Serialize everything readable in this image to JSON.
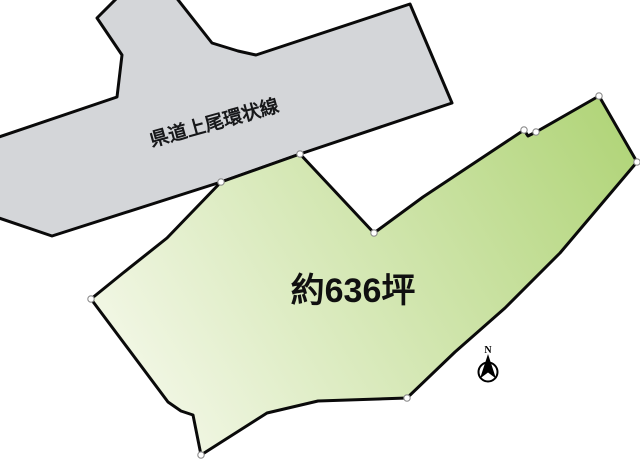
{
  "canvas": {
    "width": 640,
    "height": 461,
    "background": "#ffffff"
  },
  "road": {
    "label": "県道上尾環状線",
    "fill": "#d4d6d9",
    "stroke": "#0a0a0a",
    "stroke_width": 3,
    "points": [
      [
        119,
        -4
      ],
      [
        175,
        -4
      ],
      [
        212,
        43
      ],
      [
        238,
        51
      ],
      [
        256,
        55
      ],
      [
        410,
        4
      ],
      [
        452,
        103
      ],
      [
        300,
        154
      ],
      [
        221,
        182
      ],
      [
        52,
        236
      ],
      [
        -4,
        217
      ],
      [
        -4,
        138
      ],
      [
        117,
        97
      ],
      [
        122,
        55
      ],
      [
        97,
        18
      ]
    ],
    "label_center": [
      216,
      129
    ],
    "label_rotation_deg": -15.5,
    "label_font_size": 19
  },
  "parcel": {
    "label": "約636坪",
    "fill_gradient": {
      "from": "#f6f9ec",
      "to": "#aed374",
      "x1": 120,
      "y1": 430,
      "x2": 645,
      "y2": 110
    },
    "stroke": "#0a0a0a",
    "stroke_width": 3,
    "points": [
      [
        221,
        182
      ],
      [
        300,
        154
      ],
      [
        374,
        233
      ],
      [
        423,
        197
      ],
      [
        524,
        130
      ],
      [
        528,
        136
      ],
      [
        536,
        132
      ],
      [
        599,
        96
      ],
      [
        637,
        162
      ],
      [
        560,
        253
      ],
      [
        505,
        308
      ],
      [
        455,
        352
      ],
      [
        407,
        398
      ],
      [
        318,
        401
      ],
      [
        267,
        413
      ],
      [
        201,
        455
      ],
      [
        193,
        415
      ],
      [
        181,
        411
      ],
      [
        168,
        402
      ],
      [
        91,
        299
      ],
      [
        123,
        273
      ],
      [
        167,
        238
      ]
    ],
    "label_center": [
      353,
      290
    ],
    "label_font_size": 34
  },
  "vertex_markers": {
    "fill": "#ffffff",
    "stroke": "#8c8c8c",
    "stroke_width": 1.1,
    "radius": 3.2,
    "points": [
      [
        91,
        299
      ],
      [
        221,
        182
      ],
      [
        300,
        154
      ],
      [
        374,
        233
      ],
      [
        524,
        130
      ],
      [
        536,
        132
      ],
      [
        599,
        96
      ],
      [
        637,
        162
      ],
      [
        407,
        398
      ],
      [
        201,
        455
      ]
    ]
  },
  "compass": {
    "label": "N",
    "cx": 488,
    "cy": 372,
    "r": 9.5,
    "circle_fill": "#ffffff",
    "arrow_fill": "#000000",
    "stroke": "#000000",
    "stroke_width": 2,
    "label_font_size": 10,
    "label_y": 353
  }
}
